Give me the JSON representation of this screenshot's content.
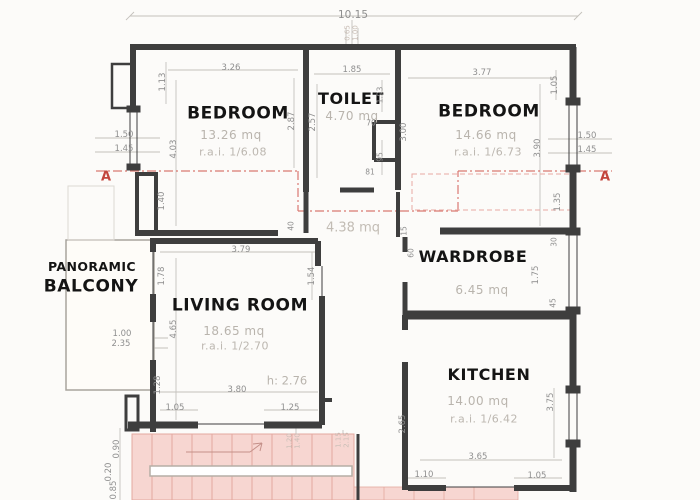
{
  "plan": {
    "section_marker": "A",
    "rooms": {
      "bedroom_left": {
        "name": "BEDROOM",
        "area": "13.26 mq",
        "rai": "r.a.i. 1/6.08"
      },
      "toilet": {
        "name": "TOILET",
        "area": "4.70 mq"
      },
      "bedroom_right": {
        "name": "BEDROOM",
        "area": "14.66 mq",
        "rai": "r.a.i. 1/6.73"
      },
      "hall": {
        "area": "4.38 mq"
      },
      "wardrobe": {
        "name": "WARDROBE",
        "area": "6.45 mq"
      },
      "living_room": {
        "name": "LIVING ROOM",
        "area": "18.65 mq",
        "rai": "r.a.i. 1/2.70"
      },
      "kitchen": {
        "name": "KITCHEN",
        "area": "14.00 mq",
        "rai": "r.a.i. 1/6.42"
      },
      "balcony": {
        "name_line1": "PANORAMIC",
        "name_line2": "BALCONY"
      }
    },
    "ceiling_height": "h: 2.76",
    "dims": {
      "overall_width": "10.15",
      "top_center_a": "0.65",
      "top_center_b": "1.00",
      "bl_width": "3.26",
      "bl_left_top": "1.13",
      "bl_left": "4.03",
      "bl_right": "2.87",
      "toilet_width": "1.85",
      "toilet_left": "2.57",
      "toilet_right_top": "1.93",
      "toilet_niche_w": "70",
      "toilet_niche_h": "95",
      "toilet_door": "81",
      "mid_wall": "3.00",
      "br_width": "3.77",
      "br_right_top": "1.05",
      "br_right": "3.90",
      "left_win_a": "1.50",
      "left_win_b": "1.45",
      "left_jamb": "1.40",
      "right_win_a": "1.50",
      "right_win_b": "1.45",
      "right_jamb": "1.35",
      "hall_wall_a": "40",
      "hall_wall_b": "15",
      "ward_left": "60",
      "ward_right_top": "30",
      "ward_window": "1.75",
      "ward_right_bot": "45",
      "lr_width": "3.79",
      "lr_left_top": "1.78",
      "lr_right_door": "1.54",
      "lr_left": "4.65",
      "balc_door": "1.00",
      "balc_width": "2.35",
      "lr_bot_left": "1.28",
      "lr_bot_width": "3.80",
      "lr_bot_seg1": "1.05",
      "lr_bot_seg2": "1.25",
      "kit_left": "2.65",
      "kit_right": "3.75",
      "kit_bot_width": "3.65",
      "kit_bot_seg1": "1.10",
      "kit_bot_seg2": "1.05",
      "stair_a": "1.20",
      "stair_b": "1.40",
      "stair_c": "1.15",
      "stair_d": "2.15",
      "out_a": "0.90",
      "out_b": "0.20",
      "out_c": "0.85"
    },
    "colors": {
      "wall": "#3e3e3e",
      "dim_text": "#8f8f8f",
      "area_text": "#b9b4ad",
      "section_red": "#c3453c",
      "stairs_fill": "#f7d6d1",
      "stairs_line": "#e3a89f"
    }
  }
}
